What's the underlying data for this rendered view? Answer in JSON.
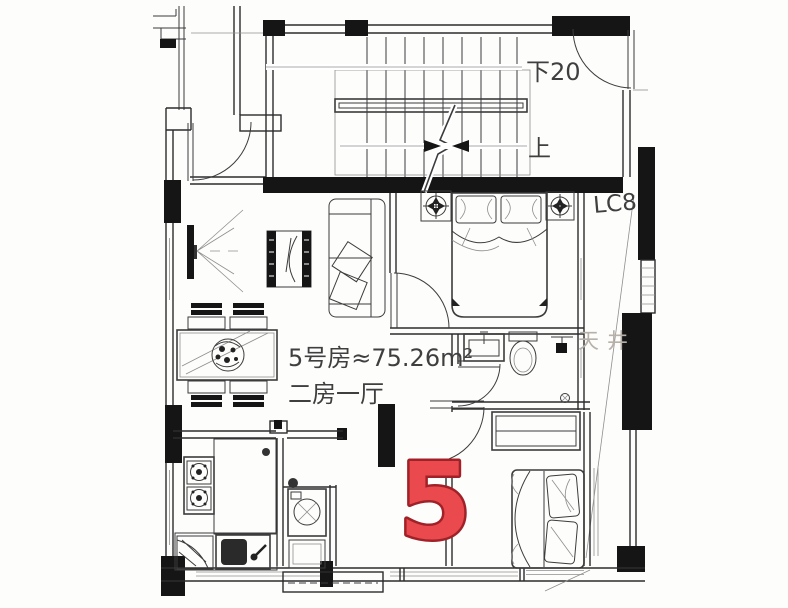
{
  "plan": {
    "unit_number": "5",
    "area_text": "5号房≈75.26m²",
    "layout_text": "二房一厅",
    "stairs": {
      "down_label": "下20",
      "up_label": "上"
    },
    "labels": {
      "window_code": "LC8",
      "light_well": "天井"
    }
  },
  "colors": {
    "line": "#2c2c2c",
    "wall_fill": "#151515",
    "unit_number_fill": "#ea4a4e",
    "unit_number_stroke": "#a02228",
    "muted_label": "#b7b1aa",
    "paper": "#fdfdfc"
  }
}
